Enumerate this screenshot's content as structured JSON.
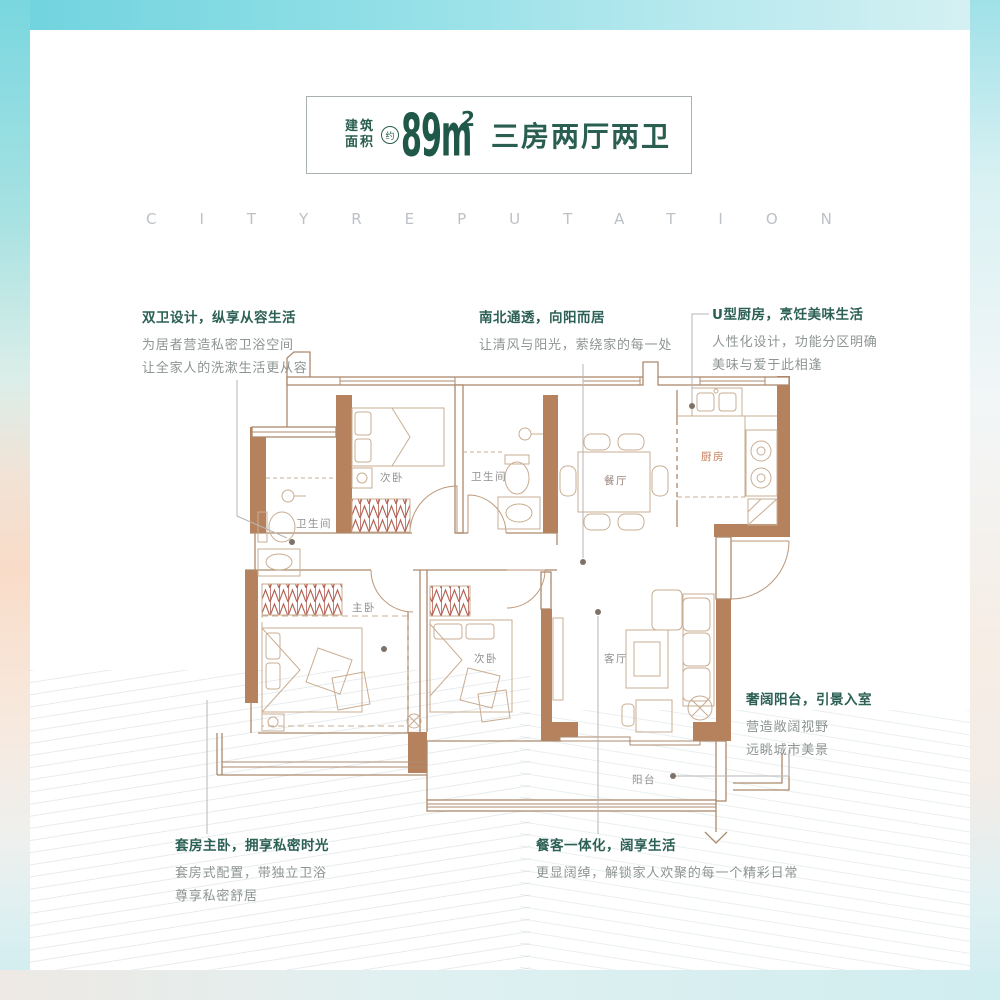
{
  "colors": {
    "accent_green": "#2a5e50",
    "wall_brown": "#b5825d",
    "frame_teal": "#7fd8e1",
    "frame_peach": "#f8ddc9",
    "label_gray": "#8f8f8f",
    "kitchen_label_orange": "#c57a52"
  },
  "header": {
    "area_label_line1": "建筑",
    "area_label_line2": "面积",
    "approx_badge": "约",
    "area_value": "89m",
    "area_superscript": "2",
    "layout_text": "三房两厅两卫"
  },
  "watermark": {
    "text": "CITYREPUTATION"
  },
  "callouts": [
    {
      "title": "双卫设计，纵享从容生活",
      "lines": [
        "为居者营造私密卫浴空间",
        "让全家人的洗漱生活更从容"
      ]
    },
    {
      "title": "南北通透，向阳而居",
      "lines": [
        "让清风与阳光，萦绕家的每一处"
      ]
    },
    {
      "title": "U型厨房，烹饪美味生活",
      "lines": [
        "人性化设计，功能分区明确",
        "美味与爱于此相逢"
      ]
    },
    {
      "title": "奢阔阳台，引景入室",
      "lines": [
        "营造敞阔视野",
        "远眺城市美景"
      ]
    },
    {
      "title": "套房主卧，拥享私密时光",
      "lines": [
        "套房式配置，带独立卫浴",
        "尊享私密舒居"
      ]
    },
    {
      "title": "餐客一体化，阔享生活",
      "lines": [
        "更显阔绰，解锁家人欢聚的每一个精彩日常"
      ]
    }
  ],
  "rooms": [
    {
      "label": "次卧"
    },
    {
      "label": "卫生间"
    },
    {
      "label": "卫生间"
    },
    {
      "label": "餐厅"
    },
    {
      "label": "厨房"
    },
    {
      "label": "主卧"
    },
    {
      "label": "次卧"
    },
    {
      "label": "客厅"
    },
    {
      "label": "阳台"
    }
  ]
}
